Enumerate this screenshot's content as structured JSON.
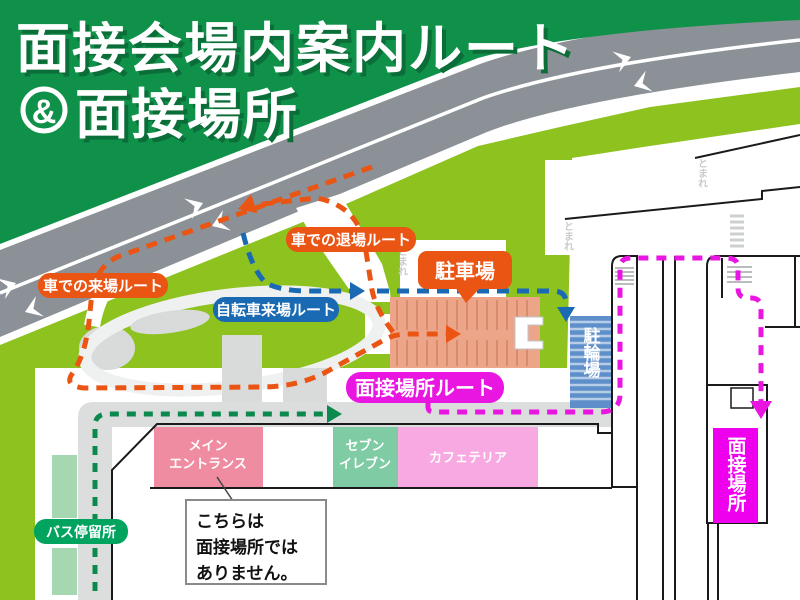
{
  "title": {
    "line1": "面接会場内案内ルート",
    "ampersand": "&",
    "line2": "面接場所"
  },
  "routes": {
    "car_arrival": {
      "label": "車での来場ルート",
      "color": "#ea5514"
    },
    "car_exit": {
      "label": "車での退場ルート",
      "color": "#ea5514"
    },
    "bicycle": {
      "label": "自転車来場ルート",
      "color": "#1a6ab3"
    },
    "interview": {
      "label": "面接場所ルート",
      "color": "#e816e0"
    },
    "bus_walk": {
      "color": "#0c8a4d"
    }
  },
  "places": {
    "parking": "駐車場",
    "bicycle_parking": "駐輪場",
    "main_entrance": [
      "メイン",
      "エントランス"
    ],
    "seven_eleven": [
      "セブン",
      "イレブン"
    ],
    "cafeteria": "カフェテリア",
    "interview_room": "面接場所",
    "bus_stop": "バス停留所"
  },
  "callout": {
    "line1": "こちらは",
    "line2": "面接場所では",
    "line3": "ありません。"
  },
  "road_marking": "とまれ",
  "colors": {
    "banner_green": "#10914a",
    "grass_green": "#8dc21f",
    "road_gray": "#8b9196",
    "path_gray": "#dcdddd",
    "parking_salmon": "#eda58a",
    "bicycle_blue": "#5f8fca",
    "entrance_pink": "#ef8ca1",
    "seven_green": "#7ecba4",
    "cafeteria_pink": "#f8a9e2",
    "interview_magenta": "#ee00ee",
    "bus_green": "#00a45e"
  }
}
